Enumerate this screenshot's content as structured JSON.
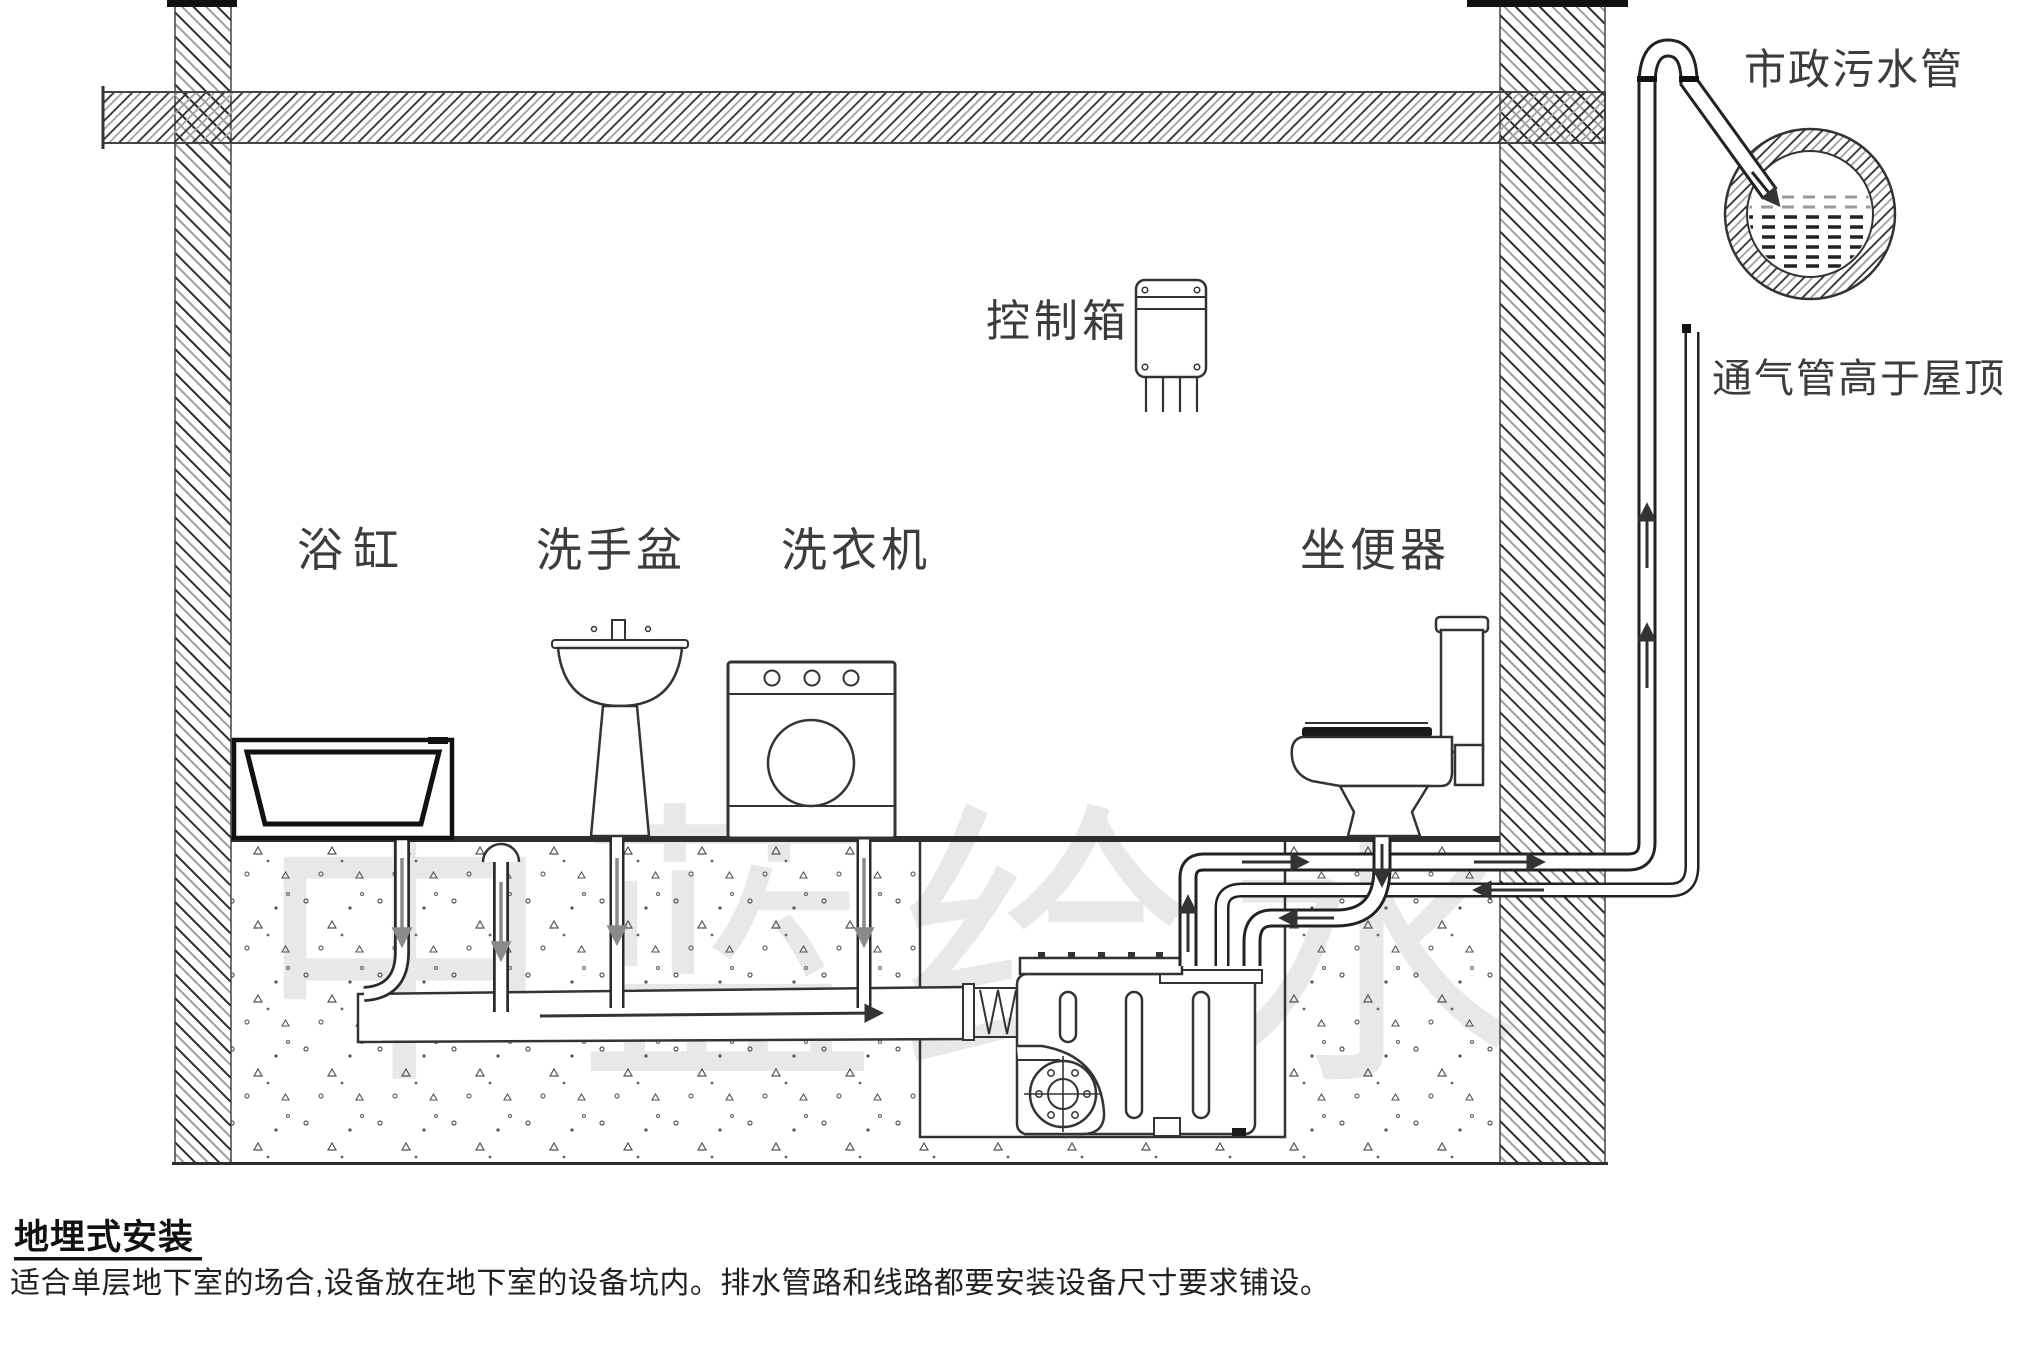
{
  "diagram": {
    "labels": {
      "bathtub": "浴缸",
      "washbasin": "洗手盆",
      "washing_machine": "洗衣机",
      "control_box": "控制箱",
      "toilet": "坐便器",
      "municipal_sewer": "市政污水管",
      "vent_pipe": "通气管高于屋顶"
    },
    "watermark": "中蓝给水",
    "line_color": "#333333",
    "soil_dot_color": "#555555",
    "watermark_color": "#e8e8e8"
  },
  "caption": {
    "title": "地埋式安装",
    "body": "适合单层地下室的场合,设备放在地下室的设备坑内。排水管路和线路都要安装设备尺寸要求铺设。"
  }
}
